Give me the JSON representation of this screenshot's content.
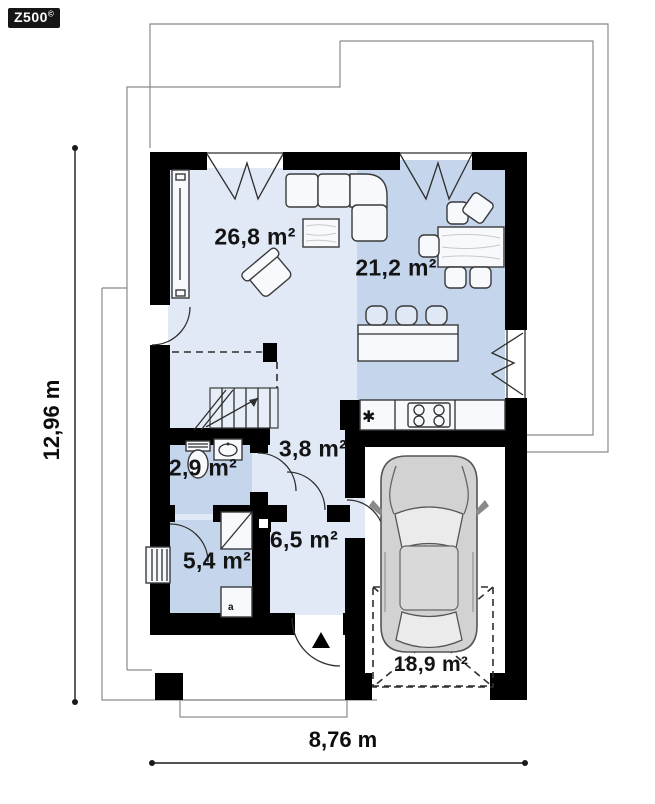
{
  "logo": {
    "text": "Z500",
    "mark": "©"
  },
  "rooms": [
    {
      "name": "living-room",
      "label": "26,8 m²"
    },
    {
      "name": "kitchen-dining",
      "label": "21,2 m²"
    },
    {
      "name": "wc",
      "label": "2,9 m²"
    },
    {
      "name": "hallway",
      "label": "3,8 m²"
    },
    {
      "name": "entry-hall",
      "label": "6,5 m²"
    },
    {
      "name": "utility-room",
      "label": "5,4 m²"
    },
    {
      "name": "garage",
      "label": "18,9 m²"
    }
  ],
  "dimensions": {
    "width": "8,76 m",
    "height": "12,96 m"
  },
  "icons": {
    "sink_star": "✱",
    "boiler_mark": "a"
  },
  "colors": {
    "wall": "#000000",
    "floor_light": "#e2e9f6",
    "floor_dark": "#c5d5ec",
    "outline": "#8a8a8a"
  }
}
